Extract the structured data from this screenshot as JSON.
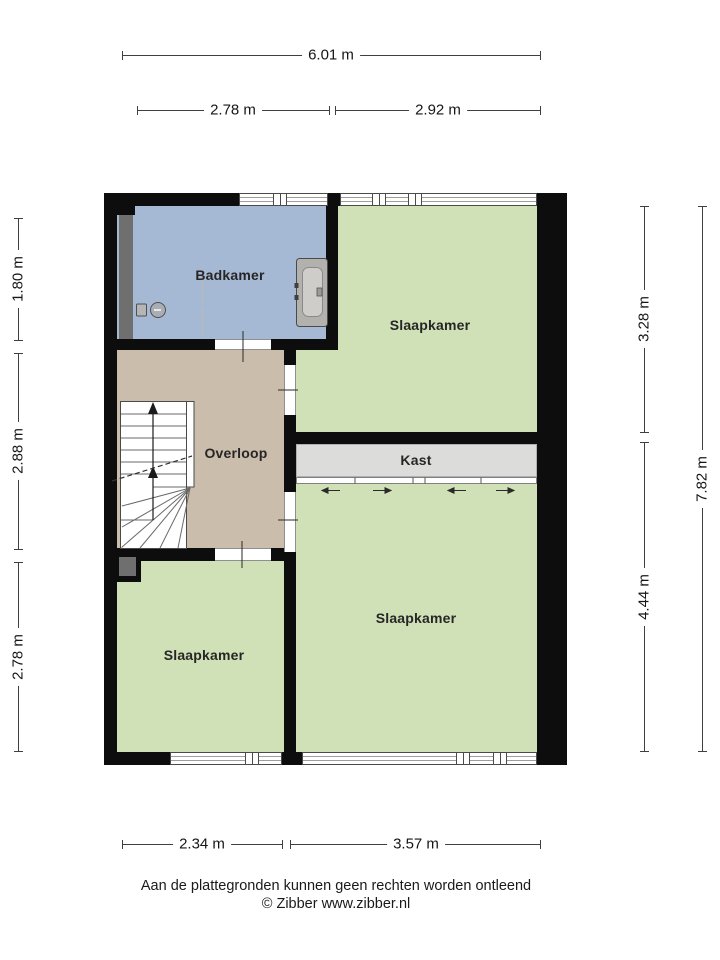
{
  "rooms": {
    "badkamer": {
      "label": "Badkamer"
    },
    "slaapkamer_top": {
      "label": "Slaapkamer"
    },
    "overloop": {
      "label": "Overloop"
    },
    "kast": {
      "label": "Kast"
    },
    "slaapkamer_left": {
      "label": "Slaapkamer"
    },
    "slaapkamer_right": {
      "label": "Slaapkamer"
    }
  },
  "dimensions": {
    "top_total": "6.01 m",
    "top_left": "2.78 m",
    "top_right": "2.92 m",
    "left_top": "1.80 m",
    "left_middle": "2.88 m",
    "left_bottom": "2.78 m",
    "right_top": "3.28 m",
    "right_bottom": "4.44 m",
    "right_total": "7.82 m",
    "bottom_left": "2.34 m",
    "bottom_right": "3.57 m"
  },
  "footer": {
    "disclaimer": "Aan de plattegronden kunnen geen rechten worden ontleend",
    "credit": "© Zibber www.zibber.nl"
  },
  "colors": {
    "bathroom": "#a6b9d4",
    "bedroom": "#d1e1b7",
    "hallway": "#cbbdab",
    "closet": "#dcdcda",
    "shaft": "#6f6f6f",
    "wall": "#0d0d0d"
  }
}
